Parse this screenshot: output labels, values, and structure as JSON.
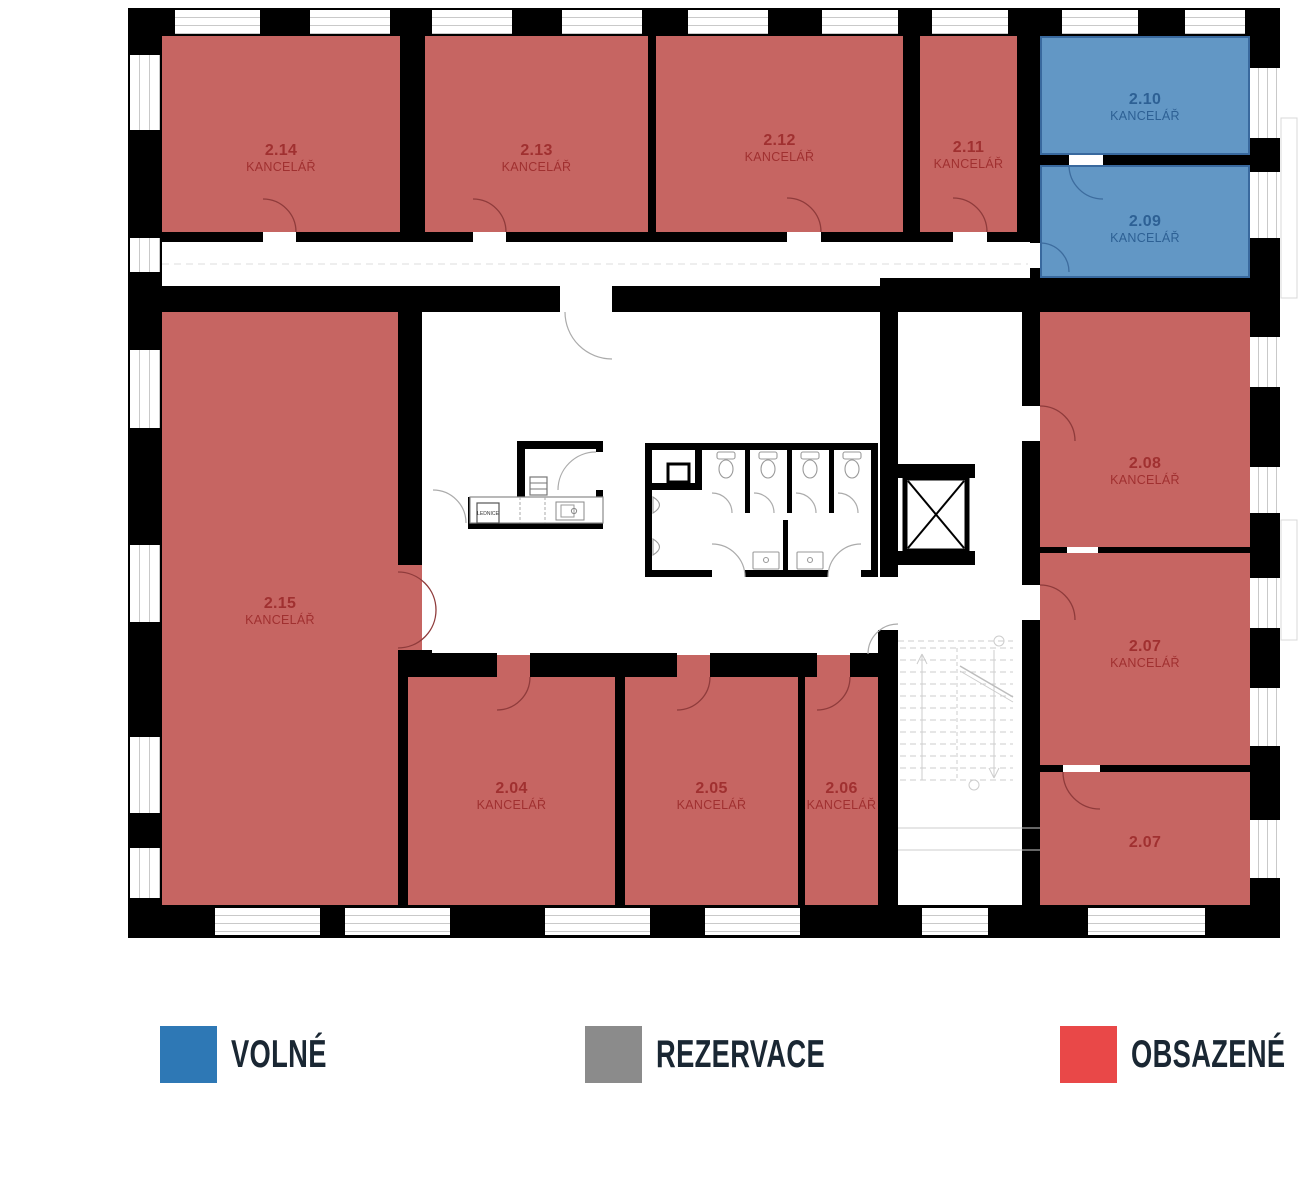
{
  "legend": {
    "items": [
      {
        "label": "VOLNÉ",
        "color": "#2E78B5",
        "meaning": "free"
      },
      {
        "label": "REZERVACE",
        "color": "#8B8B8B",
        "meaning": "reserved"
      },
      {
        "label": "OBSAZENÉ",
        "color": "#E94848",
        "meaning": "occupied"
      }
    ]
  },
  "rooms": {
    "r214": {
      "number": "2.14",
      "type": "KANCELÁŘ",
      "status": "obsazené"
    },
    "r213": {
      "number": "2.13",
      "type": "KANCELÁŘ",
      "status": "obsazené"
    },
    "r212": {
      "number": "2.12",
      "type": "KANCELÁŘ",
      "status": "obsazené"
    },
    "r211": {
      "number": "2.11",
      "type": "KANCELÁŘ",
      "status": "obsazené"
    },
    "r210": {
      "number": "2.10",
      "type": "KANCELÁŘ",
      "status": "volné"
    },
    "r209": {
      "number": "2.09",
      "type": "KANCELÁŘ",
      "status": "volné"
    },
    "r215": {
      "number": "2.15",
      "type": "KANCELÁŘ",
      "status": "obsazené"
    },
    "r208": {
      "number": "2.08",
      "type": "KANCELÁŘ",
      "status": "obsazené"
    },
    "r207": {
      "number": "2.07",
      "type": "KANCELÁŘ",
      "status": "obsazené"
    },
    "r207b": {
      "number": "2.07",
      "type": "",
      "status": "obsazené"
    },
    "r204": {
      "number": "2.04",
      "type": "KANCELÁŘ",
      "status": "obsazené"
    },
    "r205": {
      "number": "2.05",
      "type": "KANCELÁŘ",
      "status": "obsazené"
    },
    "r206": {
      "number": "2.06",
      "type": "KANCELÁŘ",
      "status": "obsazené"
    }
  },
  "fixtures": {
    "fridge_label": "LEDNICE"
  },
  "colors": {
    "occupied_fill": "#C66562",
    "occupied_text": "#A03030",
    "free_fill": "#6297C5",
    "free_text": "#2D6094",
    "free_border": "#39699E",
    "wall": "#000000",
    "legend_text": "#1A2733"
  }
}
